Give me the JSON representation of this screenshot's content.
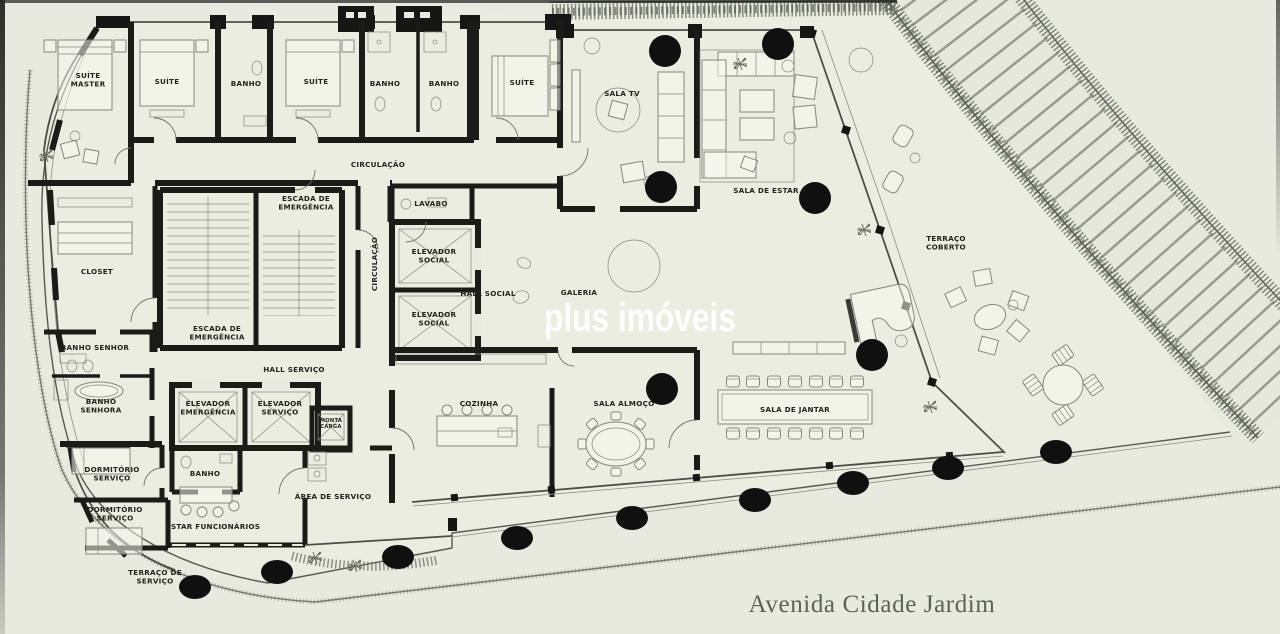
{
  "page": {
    "background": "#e8eadf",
    "property_fill": "#ebede1"
  },
  "watermark": {
    "text": "plus imóveis",
    "color": "#ffffff"
  },
  "street": {
    "name": "Avenida Cidade Jardim",
    "color": "#5d6258"
  },
  "plan": {
    "wall_color": "#1b1b18",
    "line_color": "#565a50",
    "furniture_color": "#84887b",
    "foliage_color": "#6c7163",
    "column_color": "#101010",
    "rooms": [
      {
        "lines": [
          "SUÍTE",
          "MASTER"
        ],
        "x": 88,
        "y": 80
      },
      {
        "lines": [
          "SUÍTE"
        ],
        "x": 167,
        "y": 82
      },
      {
        "lines": [
          "BANHO"
        ],
        "x": 246,
        "y": 84
      },
      {
        "lines": [
          "SUÍTE"
        ],
        "x": 316,
        "y": 82
      },
      {
        "lines": [
          "BANHO"
        ],
        "x": 385,
        "y": 84
      },
      {
        "lines": [
          "BANHO"
        ],
        "x": 444,
        "y": 84
      },
      {
        "lines": [
          "SUÍTE"
        ],
        "x": 522,
        "y": 83
      },
      {
        "lines": [
          "SALA TV"
        ],
        "x": 622,
        "y": 94
      },
      {
        "lines": [
          "SALA DE ESTAR"
        ],
        "x": 766,
        "y": 191
      },
      {
        "lines": [
          "CIRCULAÇÃO"
        ],
        "x": 378,
        "y": 165
      },
      {
        "lines": [
          "ESCADA DE",
          "EMERGÊNCIA"
        ],
        "x": 306,
        "y": 203
      },
      {
        "lines": [
          "LAVABO"
        ],
        "x": 431,
        "y": 204
      },
      {
        "lines": [
          "CLOSET"
        ],
        "x": 97,
        "y": 272
      },
      {
        "lines": [
          "CIRCULAÇÃO"
        ],
        "x": 375,
        "y": 264,
        "rot": -90
      },
      {
        "lines": [
          "ELEVADOR",
          "SOCIAL"
        ],
        "x": 434,
        "y": 256
      },
      {
        "lines": [
          "ELEVADOR",
          "SOCIAL"
        ],
        "x": 434,
        "y": 319
      },
      {
        "lines": [
          "HALL SOCIAL"
        ],
        "x": 488,
        "y": 294
      },
      {
        "lines": [
          "GALERIA"
        ],
        "x": 579,
        "y": 293
      },
      {
        "lines": [
          "BANHO SENHOR"
        ],
        "x": 95,
        "y": 348
      },
      {
        "lines": [
          "ESCADA DE",
          "EMERGÊNCIA"
        ],
        "x": 217,
        "y": 333
      },
      {
        "lines": [
          "HALL SERVIÇO"
        ],
        "x": 294,
        "y": 370
      },
      {
        "lines": [
          "BANHO",
          "SENHORA"
        ],
        "x": 101,
        "y": 406
      },
      {
        "lines": [
          "ELEVADOR",
          "EMERGÊNCIA"
        ],
        "x": 208,
        "y": 408
      },
      {
        "lines": [
          "ELEVADOR",
          "SERVIÇO"
        ],
        "x": 280,
        "y": 408
      },
      {
        "lines": [
          "MONTA",
          "CARGA"
        ],
        "x": 331,
        "y": 423,
        "small": true
      },
      {
        "lines": [
          "BANHO"
        ],
        "x": 205,
        "y": 474
      },
      {
        "lines": [
          "DORMITÓRIO",
          "SERVIÇO"
        ],
        "x": 112,
        "y": 474
      },
      {
        "lines": [
          "DORMITÓRIO",
          "SERVIÇO"
        ],
        "x": 115,
        "y": 514
      },
      {
        "lines": [
          "ESTAR FUNCIONÁRIOS"
        ],
        "x": 213,
        "y": 527
      },
      {
        "lines": [
          "ÁREA DE SERVIÇO"
        ],
        "x": 333,
        "y": 497
      },
      {
        "lines": [
          "COZINHA"
        ],
        "x": 479,
        "y": 404
      },
      {
        "lines": [
          "SALA ALMOÇO"
        ],
        "x": 624,
        "y": 404
      },
      {
        "lines": [
          "SALA DE JANTAR"
        ],
        "x": 795,
        "y": 410
      },
      {
        "lines": [
          "TERRAÇO DE",
          "SERVIÇO"
        ],
        "x": 155,
        "y": 577
      },
      {
        "lines": [
          "TERRAÇO",
          "COBERTO"
        ],
        "x": 946,
        "y": 243
      }
    ],
    "columns": [
      {
        "x": 665,
        "y": 51,
        "c": true
      },
      {
        "x": 778,
        "y": 44,
        "c": true
      },
      {
        "x": 661,
        "y": 187,
        "c": true
      },
      {
        "x": 815,
        "y": 198,
        "c": true
      },
      {
        "x": 662,
        "y": 389,
        "c": true
      },
      {
        "x": 872,
        "y": 355,
        "c": true
      },
      {
        "x": 195,
        "y": 587
      },
      {
        "x": 277,
        "y": 572
      },
      {
        "x": 398,
        "y": 557
      },
      {
        "x": 517,
        "y": 538
      },
      {
        "x": 632,
        "y": 518
      },
      {
        "x": 755,
        "y": 500
      },
      {
        "x": 853,
        "y": 483
      },
      {
        "x": 948,
        "y": 468
      },
      {
        "x": 1056,
        "y": 452
      }
    ]
  }
}
